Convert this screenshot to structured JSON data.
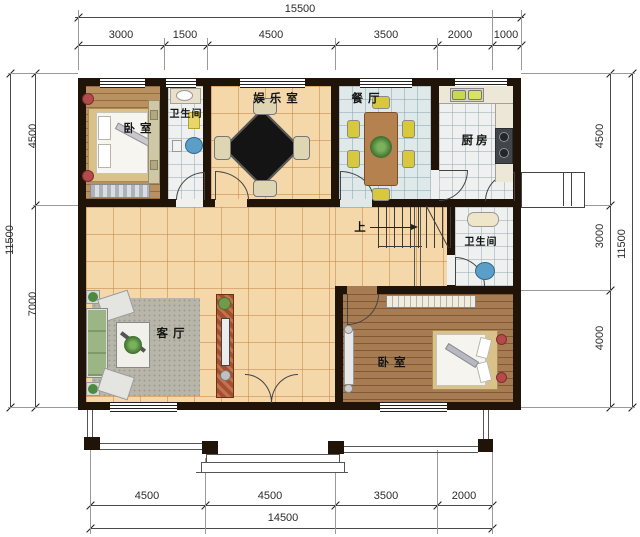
{
  "plan_type": "residential-floor-plan",
  "rooms": {
    "bedroom_top": "卧室",
    "bathroom_top": "卫生间",
    "entertainment": "娱乐室",
    "dining": "餐厅",
    "kitchen": "厨房",
    "bathroom_mid": "卫生间",
    "living": "客厅",
    "bedroom_bottom": "卧室",
    "stairs_up": "上"
  },
  "dimensions": {
    "top": {
      "total": "15500",
      "segments": [
        "3000",
        "1500",
        "4500",
        "3500",
        "2000",
        "1000"
      ]
    },
    "bottom": {
      "total": "14500",
      "segments": [
        "4500",
        "4500",
        "3500",
        "2000"
      ]
    },
    "left": {
      "total": "11500",
      "segments": [
        "4500",
        "7000"
      ]
    },
    "right": {
      "total": "11500",
      "segments": [
        "4500",
        "3000",
        "4000"
      ]
    }
  },
  "colors": {
    "wall": "#201409",
    "tile_tan": "#f4d8aa",
    "tile_blue": "#dfe9e9",
    "tile_white": "#eef1f0",
    "wood_light": "#b9905f",
    "wood_dark": "#a87c52",
    "fixture_blue": "#5b9fc9",
    "sofa_green": "#9cb585",
    "cabinet_red": "#a34f30",
    "dim_line": "#4a4a4a"
  }
}
